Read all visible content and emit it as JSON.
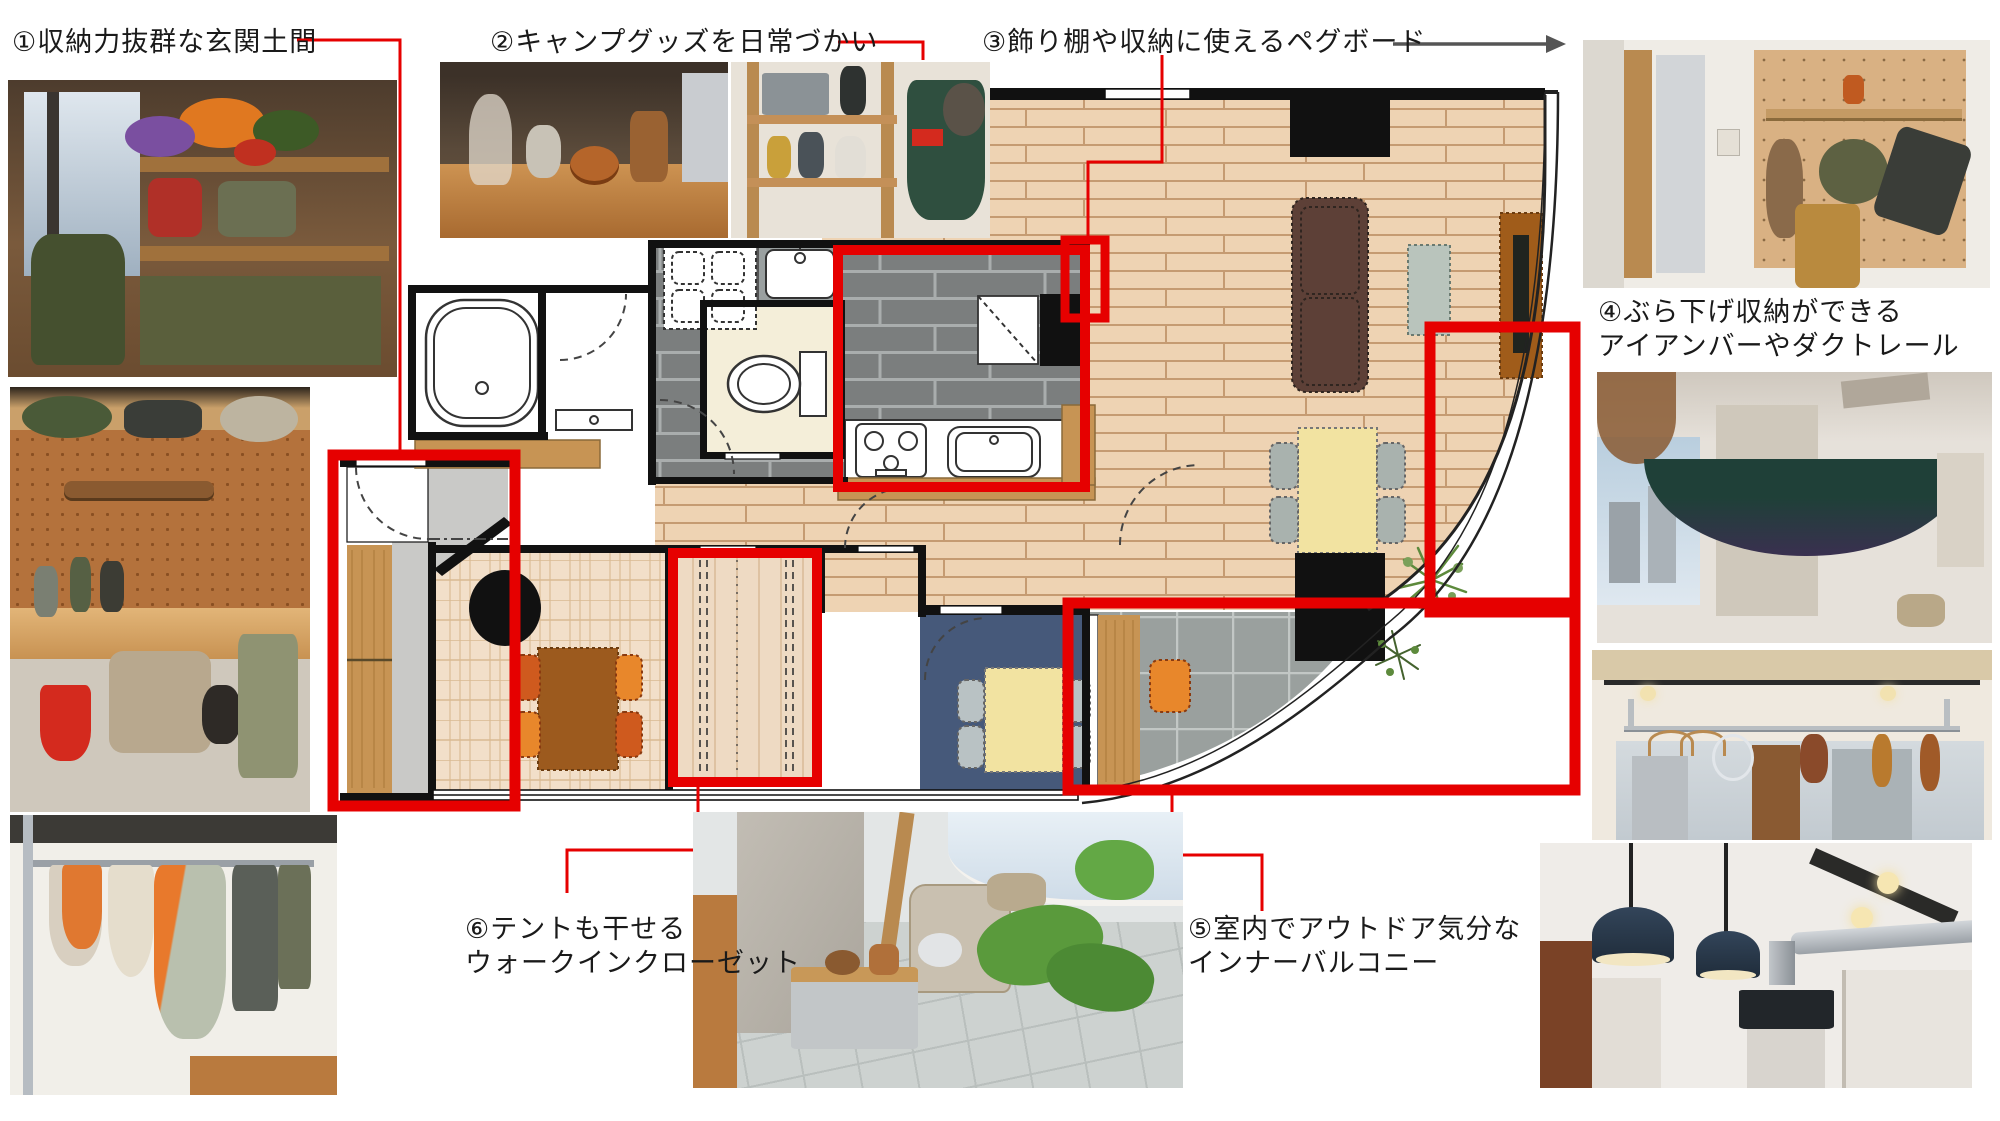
{
  "diagram_title": "",
  "annotations": {
    "label1": "①収納力抜群な玄関土間",
    "label2": "②キャンプグッズを日常づかい",
    "label3": "③飾り棚や収納に使えるペグボード",
    "label4_line1": "④ぶら下げ収納ができる",
    "label4_line2": "アイアンバーやダクトレール",
    "label5_line1": "⑤室内でアウトドア気分な",
    "label5_line2": "インナーバルコニー",
    "label6_line1": "⑥テントも干せる",
    "label6_line2": "ウォークインクローゼット"
  },
  "colors": {
    "highlight_red": "#e60000",
    "connector_red": "#e60000",
    "arrow_gray": "#555555",
    "wall_black": "#111111",
    "wood_floor": "#eed3b3",
    "kitchen_tile_gray": "#7b7e7e",
    "balcony_tile_gray": "#9aa09e",
    "doma_gray": "#c9c9c7",
    "blue_room": "#46597a"
  },
  "floor_plan": {
    "highlighted_zones": [
      {
        "id": 1,
        "zone": "entrance-doma"
      },
      {
        "id": 2,
        "zone": "kitchen"
      },
      {
        "id": 3,
        "zone": "pegboard-wall-spot"
      },
      {
        "id": 4,
        "zone": "window-side-iron-bar"
      },
      {
        "id": 5,
        "zone": "inner-balcony"
      },
      {
        "id": 6,
        "zone": "walk-in-closet"
      }
    ]
  }
}
